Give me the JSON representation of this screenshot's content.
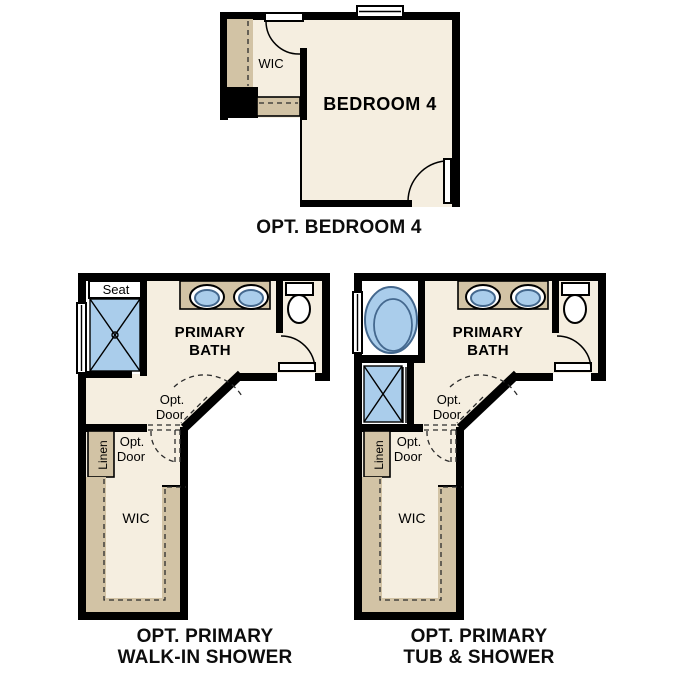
{
  "colors": {
    "background": "#ffffff",
    "wall": "#000000",
    "floor": "#f5eee0",
    "shelf": "#d2c3a5",
    "fixture_blue": "#aacdeb",
    "fixture_stroke": "#44688e",
    "dash": "#2b2b2b",
    "text": "#000000",
    "caption_text": "#0d0d0d"
  },
  "plans": {
    "bedroom4": {
      "caption": "OPT. BEDROOM 4",
      "room_label": "BEDROOM 4",
      "wic_label": "WIC"
    },
    "walk_in_shower": {
      "caption_line1": "OPT. PRIMARY",
      "caption_line2": "WALK-IN SHOWER",
      "room_label_line1": "PRIMARY",
      "room_label_line2": "BATH",
      "seat_label": "Seat",
      "linen_label": "Linen",
      "wic_label": "WIC",
      "opt_door_upper": {
        "line1": "Opt.",
        "line2": "Door"
      },
      "opt_door_lower": {
        "line1": "Opt.",
        "line2": "Door"
      }
    },
    "tub_shower": {
      "caption_line1": "OPT. PRIMARY",
      "caption_line2": "TUB & SHOWER",
      "room_label_line1": "PRIMARY",
      "room_label_line2": "BATH",
      "linen_label": "Linen",
      "wic_label": "WIC",
      "opt_door_upper": {
        "line1": "Opt.",
        "line2": "Door"
      },
      "opt_door_lower": {
        "line1": "Opt.",
        "line2": "Door"
      }
    }
  }
}
